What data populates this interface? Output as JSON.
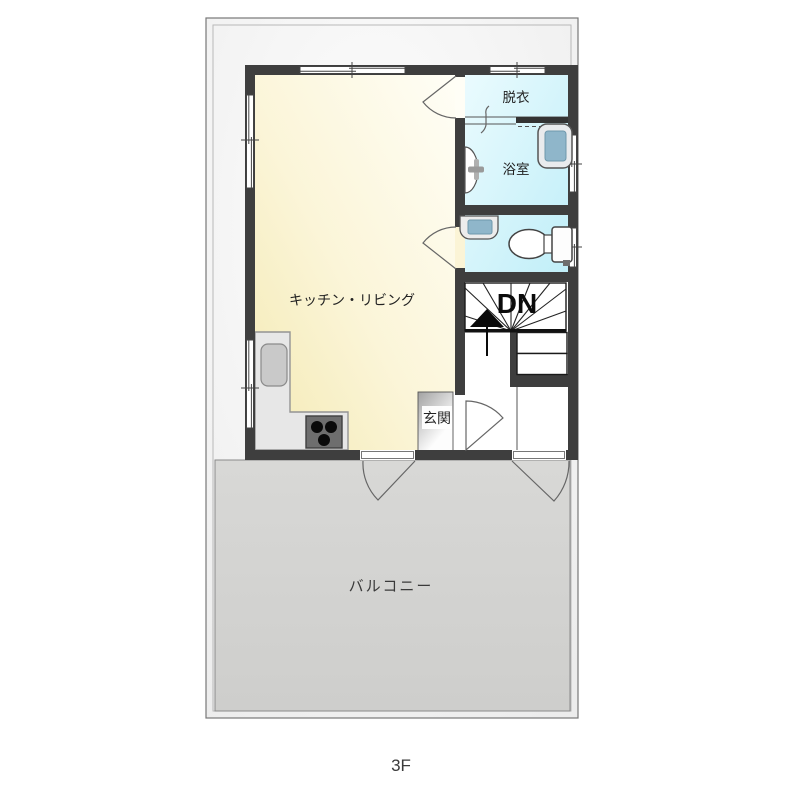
{
  "page": {
    "floor_label": "3F"
  },
  "rooms": {
    "kitchen_living": {
      "label": "キッチン・リビング"
    },
    "dressing_room": {
      "label": "脱衣"
    },
    "bathroom": {
      "label": "浴室"
    },
    "entrance": {
      "label": "玄関"
    },
    "balcony": {
      "label": "バルコニー"
    }
  },
  "stairs": {
    "label": "DN",
    "direction": "down"
  },
  "fixtures": {
    "icons": [
      "bathtub-icon",
      "toilet-icon",
      "wash-basin-icon",
      "bath-faucet-icon",
      "kitchen-sink-icon",
      "stove-icon",
      "kitchen-counter",
      "up-arrow-icon"
    ]
  },
  "colors": {
    "wall": "#3E3E3E",
    "kitchen_fill": "#F6EDBE",
    "wet_fill": "#C9F0F9",
    "balcony_fill": "#D2D2D0",
    "plan_bg": "#F5F5F5"
  }
}
